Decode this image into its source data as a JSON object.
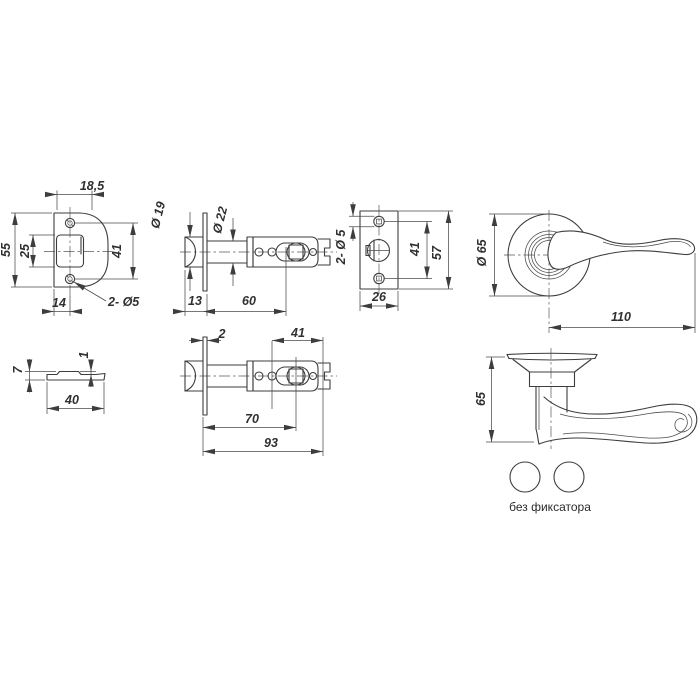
{
  "meta": {
    "drawing_type": "door knob latch set technical drawing",
    "background_color": "#ffffff",
    "line_color": "#3d3d3d",
    "text_color": "#303030"
  },
  "views": {
    "strike_plate_front": {
      "dims": {
        "top_width": "18,5",
        "height": "55",
        "cutout_height": "25",
        "screw_spacing": "41",
        "bottom_offset": "14",
        "holes_note": "2- Ø5"
      }
    },
    "latch_top": {
      "dims": {
        "bolt_diameter": "Ø 19",
        "case_diameter": "Ø 22",
        "head_length": "13",
        "case_length": "60"
      }
    },
    "faceplate_front": {
      "dims": {
        "holes_note": "2- Ø 5",
        "screw_spacing": "41",
        "height": "57",
        "width": "26"
      }
    },
    "handle_front": {
      "dims": {
        "rose_diameter": "Ø 65",
        "lever_length": "110"
      }
    },
    "strike_plate_side": {
      "dims": {
        "thickness": "7",
        "lip_height": "1",
        "width": "40"
      }
    },
    "latch_side": {
      "dims": {
        "faceplate_thickness": "2",
        "tail_length": "41",
        "backset": "70",
        "total_length": "93"
      }
    },
    "handle_side": {
      "dims": {
        "height": "65"
      }
    },
    "fixation": {
      "label": "без фиксатора"
    }
  }
}
